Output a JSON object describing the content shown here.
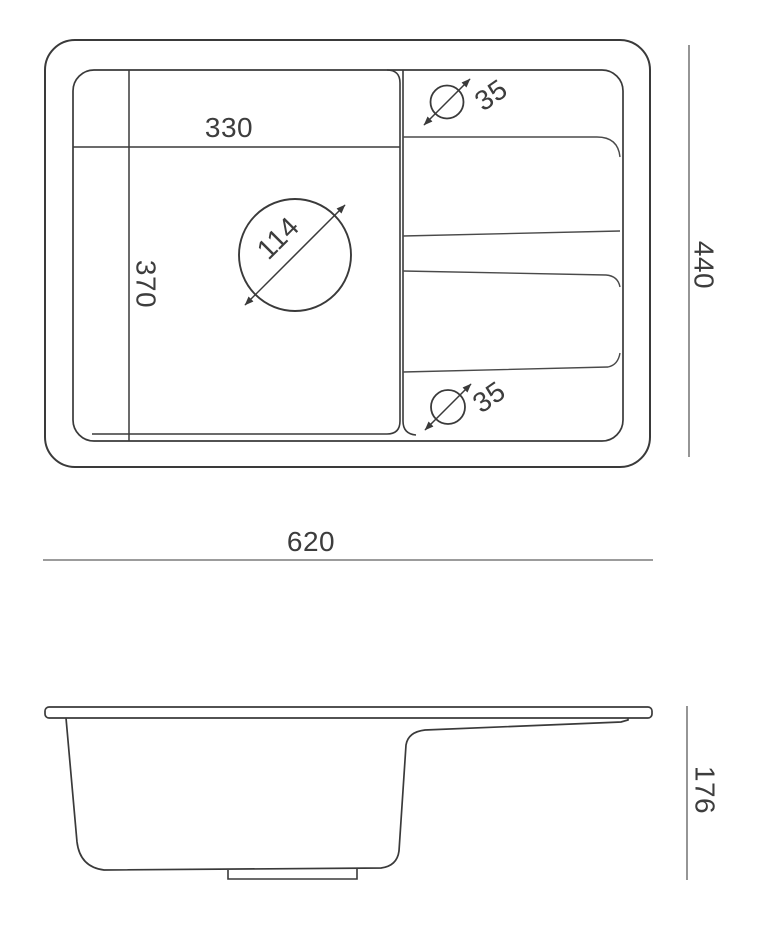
{
  "colors": {
    "line": "#3a3a3a",
    "groove_line": "#4a4a4a",
    "dim_line": "#7b7b7b",
    "text": "#3d3d3d",
    "background": "#ffffff"
  },
  "top_view": {
    "bowl_width_label": "330",
    "bowl_depth_label": "370",
    "drain_hole_diameter_label": "114",
    "tap_hole_top_diameter_label": "35",
    "tap_hole_bottom_diameter_label": "35"
  },
  "dimensions": {
    "overall_width_label": "620",
    "overall_depth_label": "440",
    "overall_height_label": "176"
  }
}
